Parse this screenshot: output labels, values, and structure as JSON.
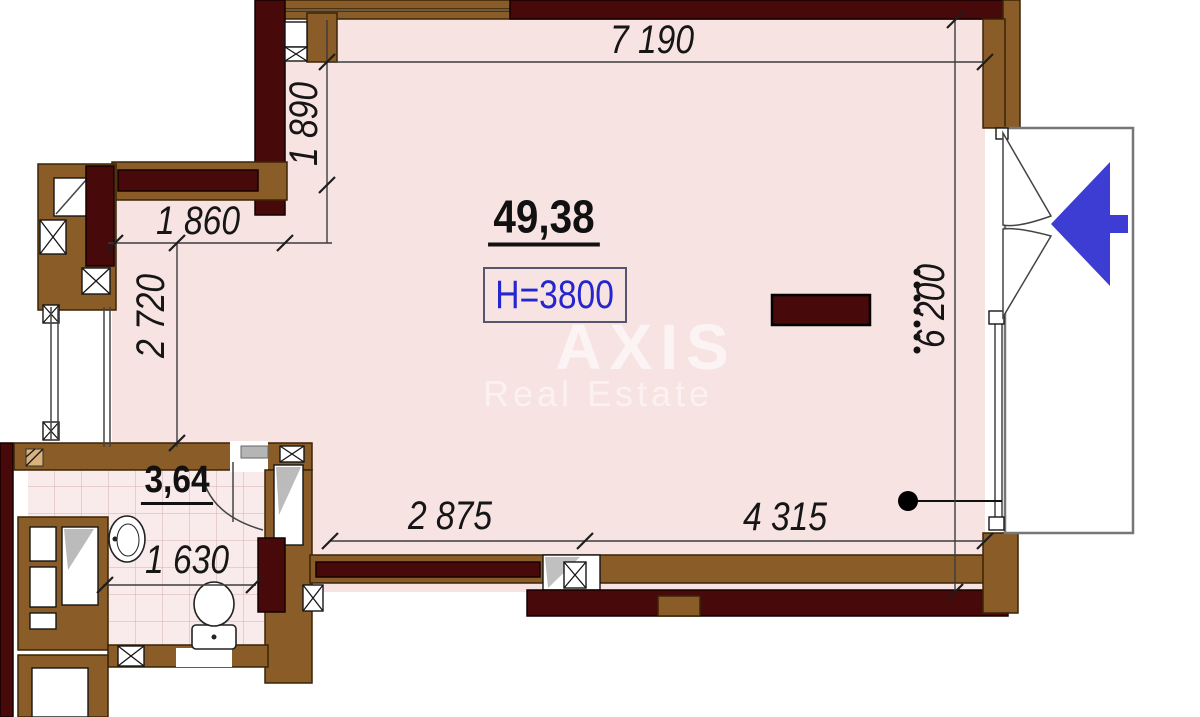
{
  "plan": {
    "main_room": {
      "area": "49,38",
      "ceiling_height": "H=3800"
    },
    "bathroom": {
      "area": "3,64"
    },
    "dimensions": {
      "top_width": "7 190",
      "upper_left_height": "1 890",
      "upper_left_width": "1 860",
      "left_height": "2 720",
      "right_height": "6 200",
      "bottom_width_left": "2 875",
      "bottom_width_right": "4 315",
      "bathroom_width": "1 630"
    },
    "watermark": {
      "line1": "AXIS",
      "line2": "Real Estate"
    },
    "colors": {
      "wall_brown": "#8a5c28",
      "wall_maroon": "#470909",
      "room_pink": "#f8e3e3",
      "arrow_blue": "#3d3dd3",
      "height_blue": "#2626cf"
    }
  }
}
